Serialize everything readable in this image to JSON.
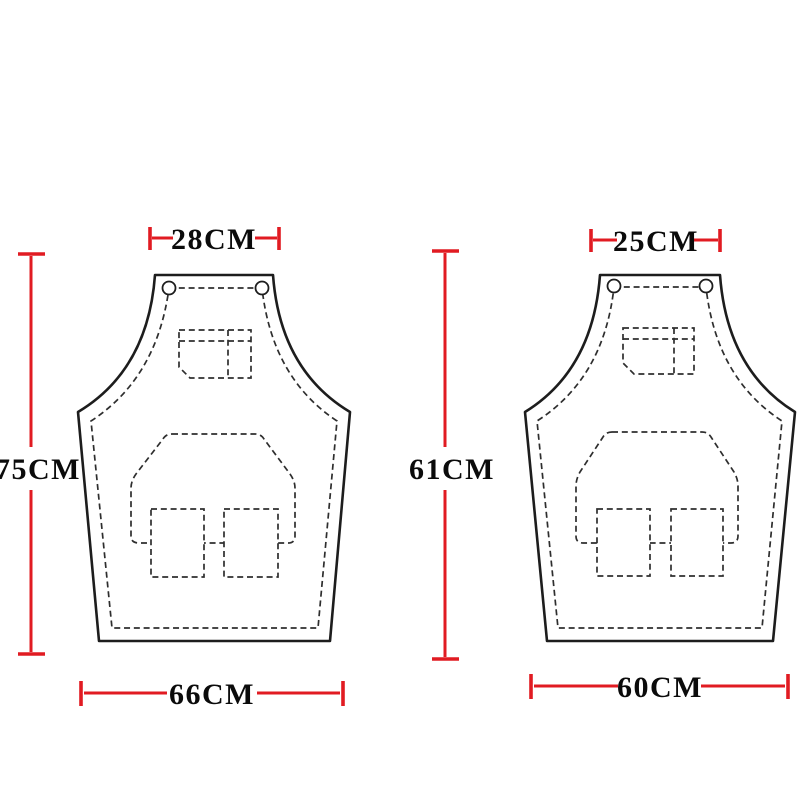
{
  "colors": {
    "dimension_red": "#e11b22",
    "outline_black": "#1d1d1d",
    "stitch_gray": "#2e2e2e",
    "background": "#ffffff"
  },
  "diagram": {
    "kind": "apron-size-specification",
    "aprons": [
      {
        "position": "left",
        "top_width": "28CM",
        "height": "75CM",
        "bottom_width": "66CM"
      },
      {
        "position": "right",
        "top_width": "25CM",
        "height": "61CM",
        "bottom_width": "60CM"
      }
    ]
  }
}
